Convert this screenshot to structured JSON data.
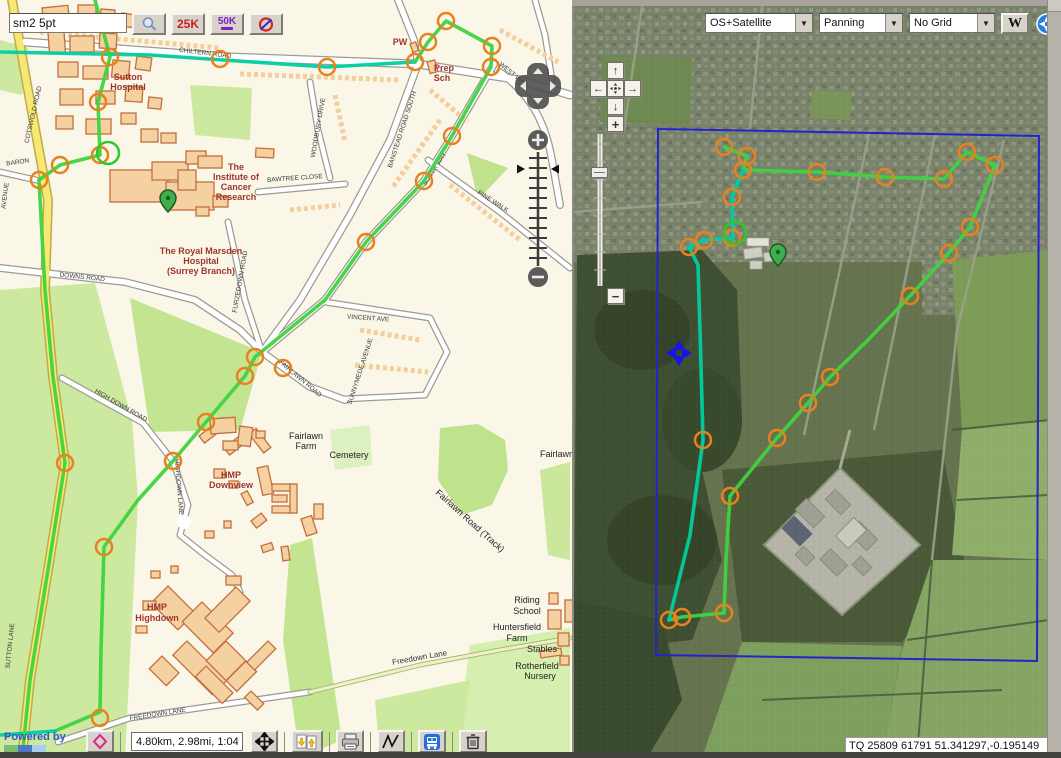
{
  "chrome": {
    "search": {
      "value": "sm2 5pt",
      "buttons": [
        {
          "name": "search",
          "icon": "magnifier-icon",
          "label": ""
        },
        {
          "name": "scale-25k",
          "label": "25K"
        },
        {
          "name": "scale-50k",
          "label": "50K"
        },
        {
          "name": "clear-overlay",
          "icon": "no-symbol-icon",
          "label": ""
        }
      ]
    },
    "right_toolbar": {
      "layer_select": "OS+Satellite",
      "mode_select": "Panning",
      "grid_select": "No Grid",
      "wikipedia_button": "W"
    },
    "bottom_toolbar": {
      "attribution": "Powered by",
      "distance_value": "4.80km, 2.98mi, 1:04",
      "buttons": [
        "routes",
        "pan-mode",
        "import-export-gpx",
        "print",
        "elevation-profile",
        "public-transport",
        "delete-route"
      ]
    },
    "coordinate_readout": "TQ 25809 61791  51.341297,-0.195149"
  },
  "colors": {
    "route_green": "#3fd33f",
    "route_teal": "#00cfa0",
    "waypoint_orange": "#e8821e",
    "current_green": "#2ec82e",
    "bounds_blue": "#2424cc",
    "pin_green": "#3faf4b",
    "pan_marker_blue": "#1515e8"
  },
  "left_map": {
    "labels": [
      {
        "t": "Sutton",
        "x": 128,
        "y": 80,
        "r": 0,
        "c": "poi"
      },
      {
        "t": "Hospital",
        "x": 128,
        "y": 90,
        "r": 0,
        "c": "poi"
      },
      {
        "t": "The",
        "x": 236,
        "y": 170,
        "r": 0,
        "c": "poi"
      },
      {
        "t": "Institute of",
        "x": 236,
        "y": 180,
        "r": 0,
        "c": "poi"
      },
      {
        "t": "Cancer",
        "x": 236,
        "y": 190,
        "r": 0,
        "c": "poi"
      },
      {
        "t": "Research",
        "x": 236,
        "y": 200,
        "r": 0,
        "c": "poi"
      },
      {
        "t": "The Royal Marsden",
        "x": 201,
        "y": 254,
        "r": 0,
        "c": "poi"
      },
      {
        "t": "Hospital",
        "x": 201,
        "y": 264,
        "r": 0,
        "c": "poi"
      },
      {
        "t": "(Surrey Branch)",
        "x": 201,
        "y": 274,
        "r": 0,
        "c": "poi"
      },
      {
        "t": "HMP",
        "x": 231,
        "y": 478,
        "r": 0,
        "c": "poi"
      },
      {
        "t": "Downview",
        "x": 231,
        "y": 488,
        "r": 0,
        "c": "poi"
      },
      {
        "t": "HMP",
        "x": 157,
        "y": 610,
        "r": 0,
        "c": "poi"
      },
      {
        "t": "Highdown",
        "x": 157,
        "y": 621,
        "r": 0,
        "c": "poi"
      },
      {
        "t": "Prep",
        "x": 444,
        "y": 71,
        "r": 0,
        "c": "poi"
      },
      {
        "t": "Sch",
        "x": 442,
        "y": 81,
        "r": 0,
        "c": "poi"
      },
      {
        "t": "PW",
        "x": 400,
        "y": 45,
        "r": 0,
        "c": "poi"
      },
      {
        "t": "Fairlawn",
        "x": 306,
        "y": 439,
        "r": 0,
        "c": "area"
      },
      {
        "t": "Farm",
        "x": 306,
        "y": 449,
        "r": 0,
        "c": "area"
      },
      {
        "t": "Cemetery",
        "x": 349,
        "y": 458,
        "r": 0,
        "c": "area"
      },
      {
        "t": "Fairlawn",
        "x": 557,
        "y": 457,
        "r": 0,
        "c": "area"
      },
      {
        "t": "Riding",
        "x": 527,
        "y": 603,
        "r": 0,
        "c": "area"
      },
      {
        "t": "School",
        "x": 527,
        "y": 614,
        "r": 0,
        "c": "area"
      },
      {
        "t": "Huntersfield",
        "x": 517,
        "y": 630,
        "r": 0,
        "c": "area"
      },
      {
        "t": "Farm",
        "x": 517,
        "y": 641,
        "r": 0,
        "c": "area"
      },
      {
        "t": "Stables",
        "x": 542,
        "y": 652,
        "r": 0,
        "c": "area"
      },
      {
        "t": "Rotherfield",
        "x": 537,
        "y": 669,
        "r": 0,
        "c": "area"
      },
      {
        "t": "Nursery",
        "x": 540,
        "y": 679,
        "r": 0,
        "c": "area"
      },
      {
        "t": "Fairlawn Road (Track)",
        "x": 468,
        "y": 523,
        "r": 42,
        "c": "area"
      },
      {
        "t": "CHILTERN ROAD",
        "x": 205,
        "y": 55,
        "r": 7,
        "c": "road"
      },
      {
        "t": "BANSTEAD ROAD SOUTH",
        "x": 404,
        "y": 130,
        "r": -72,
        "c": "road"
      },
      {
        "t": "WOODBURY DRIVE",
        "x": 320,
        "y": 128,
        "r": -80,
        "c": "road"
      },
      {
        "t": "BAWTREE CLOSE",
        "x": 295,
        "y": 180,
        "r": -4,
        "c": "road"
      },
      {
        "t": "WEST WAY",
        "x": 512,
        "y": 76,
        "r": 40,
        "c": "road"
      },
      {
        "t": "SOUTH WAY",
        "x": 436,
        "y": 170,
        "r": -57,
        "c": "road"
      },
      {
        "t": "PINE WALK",
        "x": 492,
        "y": 203,
        "r": 33,
        "c": "road"
      },
      {
        "t": "VINCENT AVE",
        "x": 368,
        "y": 320,
        "r": 4,
        "c": "road"
      },
      {
        "t": "SUNNYMEDE AVENUE",
        "x": 362,
        "y": 372,
        "r": -72,
        "c": "road"
      },
      {
        "t": "FAIRLAWN ROAD",
        "x": 299,
        "y": 380,
        "r": 40,
        "c": "road"
      },
      {
        "t": "FURZEDOWN ROAD",
        "x": 242,
        "y": 282,
        "r": -80,
        "c": "road"
      },
      {
        "t": "DOWNS ROAD",
        "x": 82,
        "y": 279,
        "r": 6,
        "c": "road"
      },
      {
        "t": "COTSWOLD ROAD",
        "x": 35,
        "y": 115,
        "r": -77,
        "c": "road"
      },
      {
        "t": "BARON",
        "x": 18,
        "y": 164,
        "r": -8,
        "c": "road"
      },
      {
        "t": "AVENUE",
        "x": 7,
        "y": 196,
        "r": -83,
        "c": "road"
      },
      {
        "t": "HIGH DOWN ROAD",
        "x": 120,
        "y": 407,
        "r": 30,
        "c": "road"
      },
      {
        "t": "HIGHDOWN LANE",
        "x": 177,
        "y": 487,
        "r": 85,
        "c": "road"
      },
      {
        "t": "FREEDOWN LANE",
        "x": 158,
        "y": 716,
        "r": -9,
        "c": "road"
      },
      {
        "t": "Freedown Lane",
        "x": 420,
        "y": 660,
        "r": -10,
        "c": "roadlc"
      },
      {
        "t": "SUTTON LANE",
        "x": 12,
        "y": 646,
        "r": -84,
        "c": "road"
      }
    ],
    "routes": [
      {
        "color": "teal",
        "pts": [
          [
            0,
            52
          ],
          [
            150,
            55
          ],
          [
            327,
            67
          ],
          [
            415,
            62
          ]
        ]
      },
      {
        "color": "green",
        "pts": [
          [
            415,
            62
          ],
          [
            428,
            42
          ],
          [
            446,
            21
          ],
          [
            492,
            46
          ],
          [
            491,
            67
          ],
          [
            452,
            136
          ],
          [
            424,
            181
          ],
          [
            366,
            242
          ],
          [
            325,
            300
          ],
          [
            255,
            357
          ],
          [
            245,
            376
          ],
          [
            206,
            422
          ],
          [
            173,
            461
          ],
          [
            138,
            500
          ],
          [
            104,
            547
          ],
          [
            101,
            650
          ],
          [
            100,
            712
          ],
          [
            55,
            731
          ]
        ]
      },
      {
        "color": "teal",
        "pts": [
          [
            55,
            731
          ],
          [
            0,
            735
          ]
        ]
      },
      {
        "color": "green",
        "pts": [
          [
            95,
            0
          ],
          [
            110,
            57
          ],
          [
            98,
            102
          ],
          [
            100,
            155
          ],
          [
            60,
            165
          ],
          [
            39,
            180
          ]
        ]
      },
      {
        "color": "green",
        "pts": [
          [
            39,
            180
          ],
          [
            45,
            290
          ],
          [
            53,
            377
          ],
          [
            65,
            463
          ],
          [
            48,
            570
          ],
          [
            30,
            680
          ],
          [
            22,
            758
          ]
        ]
      }
    ],
    "waypoints": [
      [
        110,
        57
      ],
      [
        98,
        102
      ],
      [
        100,
        155
      ],
      [
        60,
        165
      ],
      [
        39,
        180
      ],
      [
        220,
        59
      ],
      [
        327,
        67
      ],
      [
        415,
        62
      ],
      [
        428,
        42
      ],
      [
        446,
        21
      ],
      [
        492,
        46
      ],
      [
        491,
        67
      ],
      [
        452,
        136
      ],
      [
        424,
        181
      ],
      [
        366,
        242
      ],
      [
        255,
        357
      ],
      [
        283,
        368
      ],
      [
        245,
        376
      ],
      [
        206,
        422
      ],
      [
        173,
        461
      ],
      [
        65,
        463
      ],
      [
        104,
        547
      ],
      [
        100,
        718
      ]
    ],
    "current_point": {
      "x": 108,
      "y": 153
    },
    "pin": {
      "x": 168,
      "y": 212
    }
  },
  "right_map": {
    "bounds": [
      [
        656,
        129
      ],
      [
        1037,
        136
      ],
      [
        1035,
        661
      ],
      [
        654,
        655
      ]
    ],
    "routes": [
      {
        "color": "green",
        "pts": [
          [
            722,
            147
          ],
          [
            745,
            156
          ],
          [
            741,
            170
          ],
          [
            815,
            172
          ],
          [
            883,
            177
          ],
          [
            942,
            179
          ],
          [
            965,
            152
          ],
          [
            993,
            165
          ],
          [
            968,
            227
          ],
          [
            947,
            253
          ],
          [
            908,
            296
          ],
          [
            866,
            340
          ],
          [
            828,
            377
          ],
          [
            806,
            403
          ],
          [
            775,
            438
          ],
          [
            728,
            496
          ],
          [
            724,
            560
          ],
          [
            722,
            613
          ],
          [
            680,
            617
          ],
          [
            667,
            620
          ]
        ]
      },
      {
        "color": "teal",
        "pts": [
          [
            741,
            170
          ],
          [
            730,
            197
          ],
          [
            731,
            238
          ],
          [
            702,
            240
          ],
          [
            687,
            247
          ],
          [
            696,
            265
          ],
          [
            698,
            330
          ],
          [
            701,
            440
          ],
          [
            688,
            535
          ],
          [
            667,
            620
          ]
        ]
      }
    ],
    "waypoints": [
      [
        722,
        147
      ],
      [
        745,
        156
      ],
      [
        741,
        170
      ],
      [
        815,
        172
      ],
      [
        883,
        177
      ],
      [
        942,
        179
      ],
      [
        965,
        152
      ],
      [
        993,
        165
      ],
      [
        968,
        227
      ],
      [
        947,
        253
      ],
      [
        908,
        296
      ],
      [
        828,
        377
      ],
      [
        806,
        403
      ],
      [
        775,
        438
      ],
      [
        728,
        496
      ],
      [
        722,
        613
      ],
      [
        680,
        617
      ],
      [
        667,
        620
      ],
      [
        730,
        197
      ],
      [
        730,
        238
      ],
      [
        702,
        240
      ],
      [
        687,
        247
      ],
      [
        701,
        440
      ]
    ],
    "current_point": {
      "x": 733,
      "y": 233
    },
    "pin": {
      "x": 776,
      "y": 266
    },
    "pan_marker": {
      "x": 677,
      "y": 353
    }
  }
}
